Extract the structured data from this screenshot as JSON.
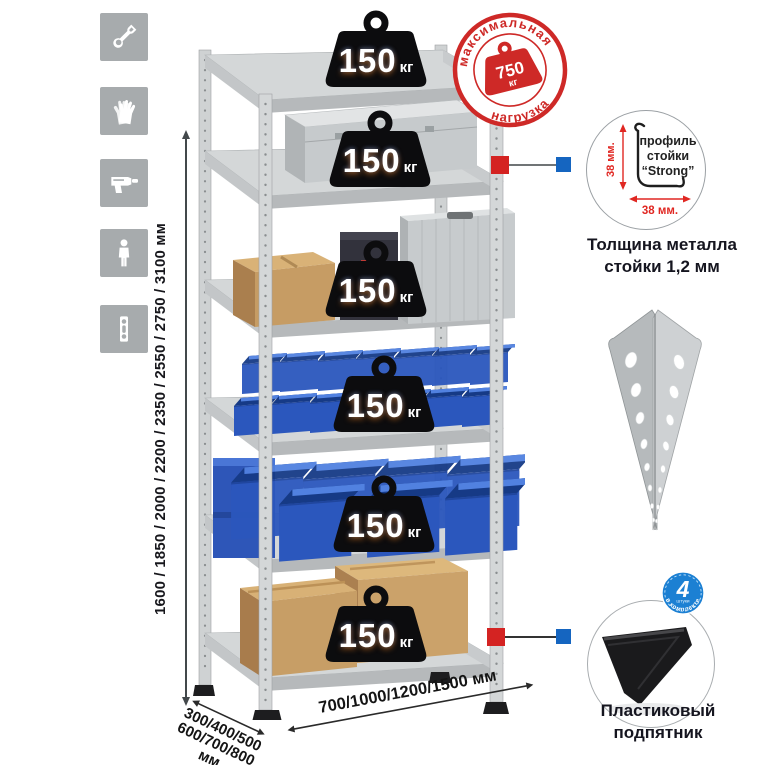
{
  "page_background": "#ffffff",
  "sidebar_icons": {
    "tile_color": "#a7abad",
    "items": [
      "wrench-icon",
      "gloves-icon",
      "drill-icon",
      "person-icon",
      "rack-post-icon"
    ]
  },
  "rack": {
    "shelf_count": 6,
    "shelf_load": {
      "value": "150",
      "unit": "кг"
    }
  },
  "max_load_stamp": {
    "arc_top": "максимальная",
    "arc_bottom": "нагрузка",
    "value": "750",
    "unit": "кг",
    "color": "#ce2927"
  },
  "height_dimension": {
    "label": "1600 / 1850 / 2000 / 2200 / 2350 / 2550 / 2750 / 3100 мм"
  },
  "depth_dimension": {
    "line1": "300/400/500",
    "line2": "600/700/800 мм"
  },
  "width_dimension": {
    "label": "700/1000/1200/1500 мм"
  },
  "profile_detail": {
    "line1": "профиль",
    "line2": "стойки",
    "line3": "“Strong”",
    "vertical_dim": "38 мм.",
    "horizontal_dim": "38 мм.",
    "caption_line1": "Толщина металла",
    "caption_line2": "стойки 1,2 мм"
  },
  "foot_detail": {
    "badge_value": "4",
    "badge_unit": "штуки",
    "badge_arc": "в комплекте",
    "caption_line1": "Пластиковый",
    "caption_line2": "подпятник"
  },
  "colors": {
    "marker_red": "#d42322",
    "marker_blue": "#1565c0",
    "bin_blue": "#2b57bd",
    "stamp_red": "#ce2927",
    "badge_blue": "#1c80d3",
    "dim_red": "#e02722"
  }
}
